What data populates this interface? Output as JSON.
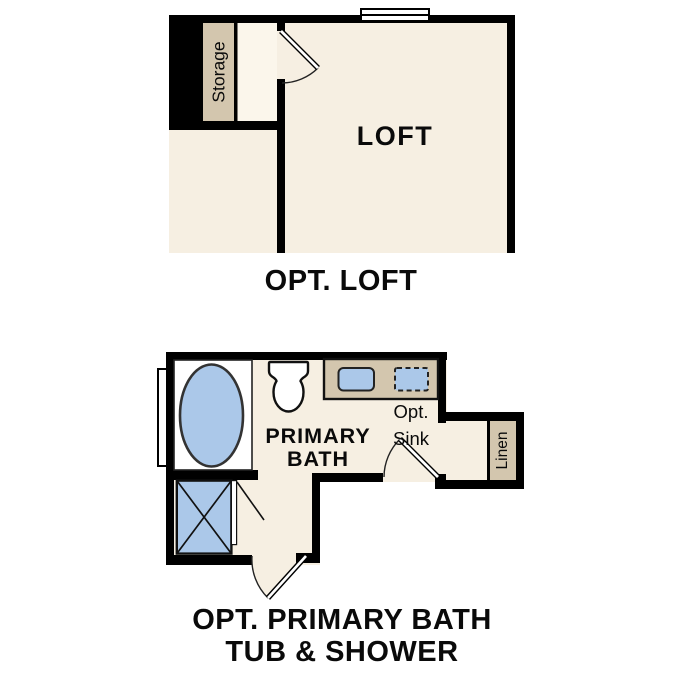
{
  "colors": {
    "wall": "#000000",
    "floor": "#f6efe2",
    "floor_light": "#fbf6eb",
    "fixture_blue": "#abc8e9",
    "cabinet_tan": "#d3c6ae",
    "white": "#ffffff"
  },
  "loft_plan": {
    "room_label": "LOFT",
    "storage_label": "Storage",
    "caption": "OPT. LOFT"
  },
  "bath_plan": {
    "room_label_line1": "PRIMARY",
    "room_label_line2": "BATH",
    "opt_sink_label_line1": "Opt.",
    "opt_sink_label_line2": "Sink",
    "linen_label": "Linen",
    "caption_line1": "OPT. PRIMARY BATH",
    "caption_line2": "TUB & SHOWER"
  }
}
